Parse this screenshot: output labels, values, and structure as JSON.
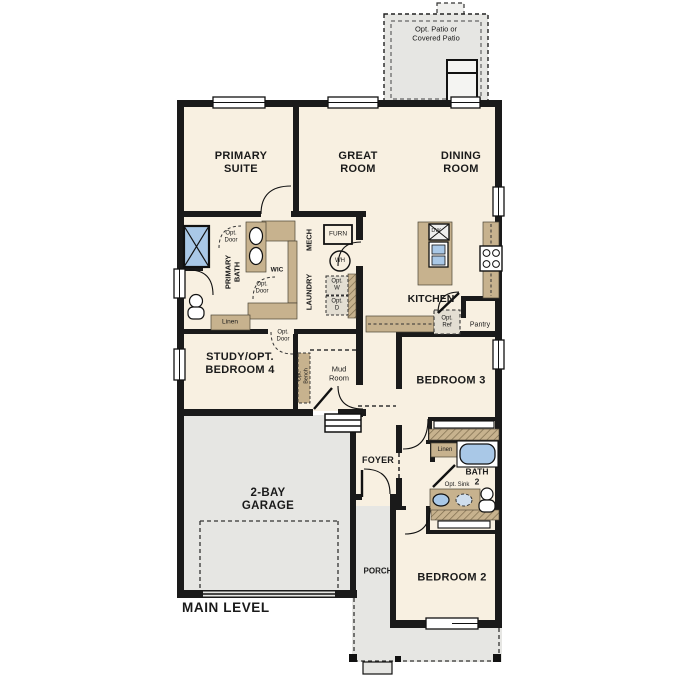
{
  "plan_title": "MAIN LEVEL",
  "rooms": {
    "patio": {
      "line1": "Opt. Patio or",
      "line2": "Covered Patio"
    },
    "primary_suite": {
      "line1": "PRIMARY",
      "line2": "SUITE"
    },
    "great_room": {
      "line1": "GREAT",
      "line2": "ROOM"
    },
    "dining_room": {
      "line1": "DINING",
      "line2": "ROOM"
    },
    "kitchen": {
      "label": "KITCHEN"
    },
    "pantry": {
      "label": "Pantry"
    },
    "study": {
      "line1": "STUDY/OPT.",
      "line2": "BEDROOM 4"
    },
    "mud_room": {
      "line1": "Mud",
      "line2": "Room"
    },
    "bedroom3": {
      "label": "BEDROOM 3"
    },
    "bedroom2": {
      "label": "BEDROOM 2"
    },
    "bath2": {
      "line1": "BATH",
      "line2": "2"
    },
    "foyer": {
      "label": "FOYER"
    },
    "porch": {
      "label": "PORCH"
    },
    "garage": {
      "line1": "2-BAY",
      "line2": "GARAGE"
    },
    "primary_bath": {
      "line1": "PRIMARY",
      "line2": "BATH"
    },
    "wic": {
      "label": "WIC"
    },
    "mech": {
      "label": "MECH"
    },
    "laundry": {
      "label": "LAUNDRY"
    }
  },
  "fixtures": {
    "furnace": "FURN",
    "water_heater": "WH",
    "opt_washer": {
      "line1": "Opt.",
      "line2": "W"
    },
    "opt_dryer": {
      "line1": "Opt.",
      "line2": "D"
    },
    "dishwasher": "DW",
    "opt_ref": {
      "line1": "Opt.",
      "line2": "Ref"
    },
    "opt_sink": "Opt. Sink",
    "opt_bench": {
      "line1": "Opt.",
      "line2": "Bench"
    },
    "linen_primary": "Linen",
    "linen_bath2": "Linen",
    "opt_door_bath": {
      "line1": "Opt.",
      "line2": "Door"
    },
    "opt_door_wic": {
      "line1": "Opt.",
      "line2": "Door"
    },
    "opt_door_study": {
      "line1": "Opt.",
      "line2": "Door"
    }
  },
  "colors": {
    "wall": "#1a1a1a",
    "room_fill": "#f8f0e1",
    "outdoor_fill": "#e6e6e3",
    "counter_tan": "#c7b28e",
    "fixture_blue": "#a9c8e7",
    "opt_box_fill": "#e3ded2"
  }
}
